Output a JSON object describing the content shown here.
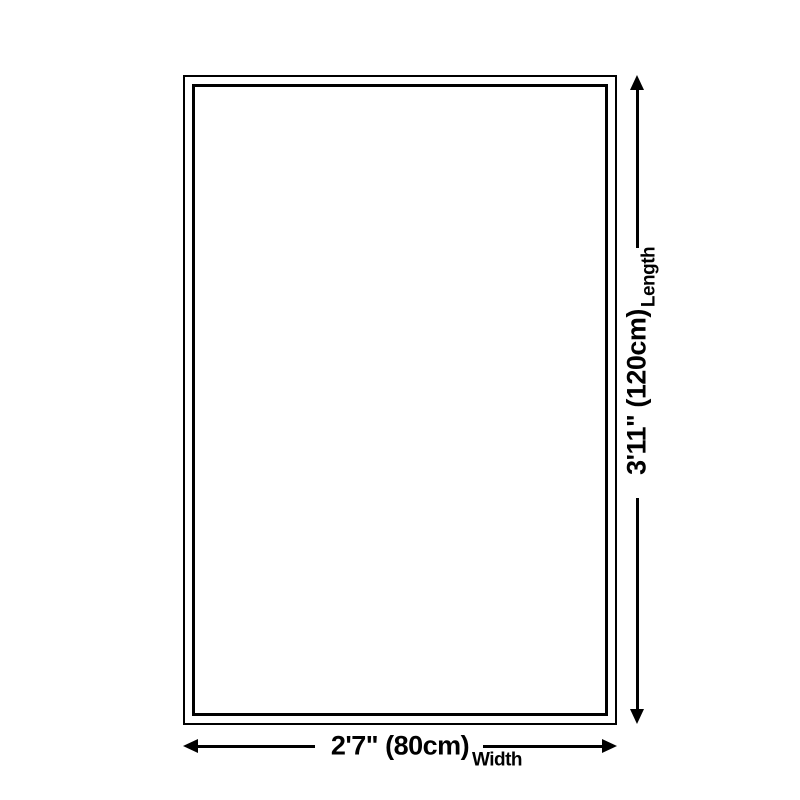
{
  "page": {
    "background_color": "#ffffff",
    "line_color": "#000000",
    "text_color": "#000000"
  },
  "diagram": {
    "kind": "rug-size-dimension-diagram",
    "shape": "rectangle-with-double-border",
    "length": {
      "value": "3'11\" (120cm)",
      "label": "Length"
    },
    "width": {
      "value": "2'7\" (80cm)",
      "label": "Width"
    }
  }
}
